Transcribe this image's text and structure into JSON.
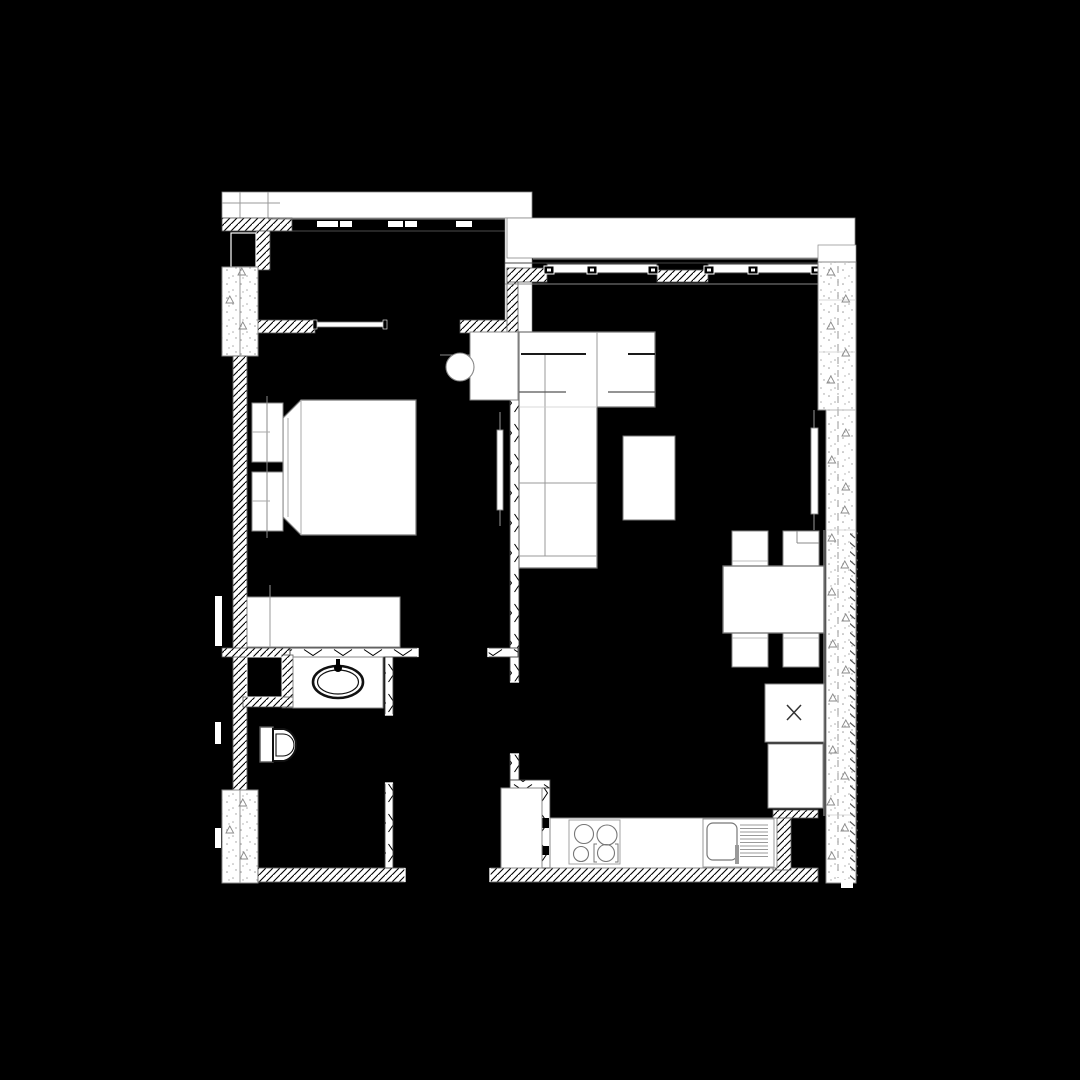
{
  "title": "apartment-floor-plan",
  "canvas": {
    "width": 1080,
    "height": 1080,
    "background_color": "#000000",
    "linework_color": "#ffffff"
  },
  "palette": {
    "background": "#000000",
    "wall_fill": "#ffffff",
    "hatch_line": "#000000",
    "outline_gray": "#777777",
    "light_gray": "#aaaaaa",
    "dark_line": "#111111",
    "glass_gray": "#555555",
    "stipple_dot": "#999999"
  },
  "rooms": [
    {
      "id": "bedroom",
      "label": "bedroom"
    },
    {
      "id": "closet",
      "label": "walk-in-closet"
    },
    {
      "id": "living-room",
      "label": "living-room"
    },
    {
      "id": "kitchen",
      "label": "kitchen"
    },
    {
      "id": "bathroom",
      "label": "bathroom"
    },
    {
      "id": "corridor",
      "label": "corridor-hall"
    },
    {
      "id": "balcony",
      "label": "balcony-strip"
    }
  ],
  "furniture": {
    "bedroom": {
      "bed": "double-bed",
      "nightstands": 2,
      "desk": "desk",
      "chair": "round-chair",
      "dresser": "dresser",
      "radiator": "radiator"
    },
    "living_room": {
      "sofa": "corner-sofa",
      "coffee_table": "coffee-table",
      "dining_table": "dining-table",
      "dining_chairs": 4,
      "fridge": "refrigerator-x-symbol",
      "unit": "tall-unit",
      "radiator": "radiator"
    },
    "kitchen": {
      "counter": "worktop",
      "cooktop_burners": 4,
      "sink": "sink-with-drainer",
      "cabinet": "hall-cabinet"
    },
    "bathroom": {
      "counter": "washbasin-counter",
      "basin": "oval-washbasin",
      "faucet": "faucet",
      "toilet": "toilet",
      "shaft": "service-shaft"
    }
  },
  "window": {
    "mullion_count": 6,
    "panes": 2
  },
  "symbols": {
    "triangle_marker": "wall-type-marker",
    "x_box": "refrigerator-symbol",
    "top_dashes": "sliding-closet-doors"
  }
}
